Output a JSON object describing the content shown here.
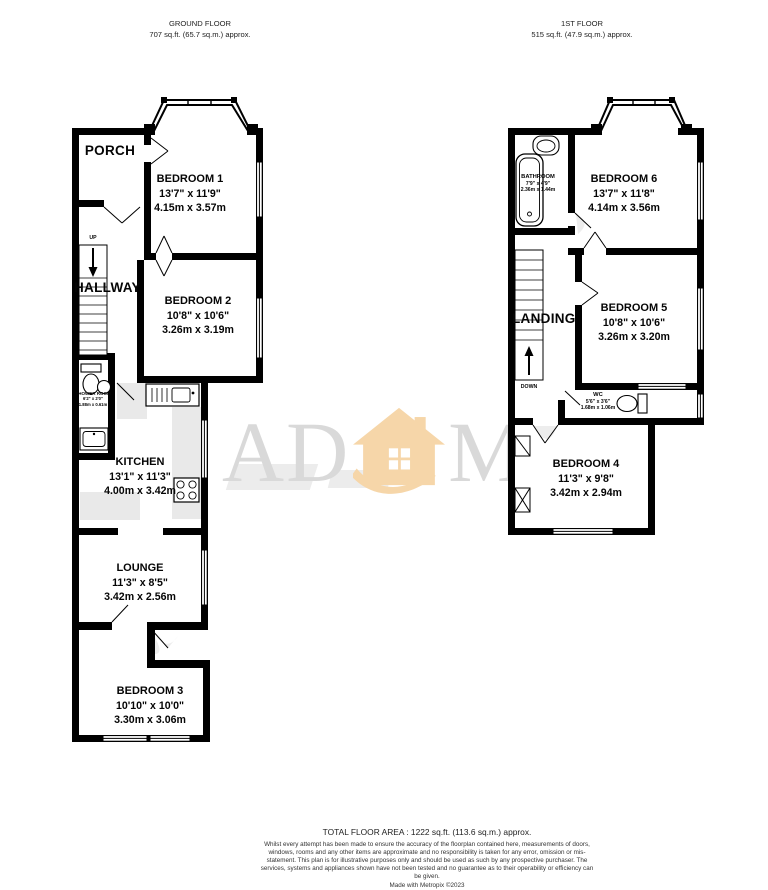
{
  "floors": {
    "ground": {
      "title": "GROUND FLOOR",
      "area": "707 sq.ft. (65.7 sq.m.) approx.",
      "stair_direction": "UP",
      "rooms": {
        "porch": {
          "name": "PORCH"
        },
        "hallway": {
          "name": "HALLWAY"
        },
        "bedroom1": {
          "name": "BEDROOM 1",
          "imperial": "13'7\" x 11'9\"",
          "metric": "4.15m x 3.57m"
        },
        "bedroom2": {
          "name": "BEDROOM 2",
          "imperial": "10'8\" x 10'6\"",
          "metric": "3.26m x 3.19m"
        },
        "shower": {
          "name": "SHOWER ROOM",
          "imperial": "6'2\" x 2'0\"",
          "metric": "1.88m x 0.61m"
        },
        "kitchen": {
          "name": "KITCHEN",
          "imperial": "13'1\" x 11'3\"",
          "metric": "4.00m x 3.42m"
        },
        "lounge": {
          "name": "LOUNGE",
          "imperial": "11'3\" x 8'5\"",
          "metric": "3.42m x 2.56m"
        },
        "bedroom3": {
          "name": "BEDROOM 3",
          "imperial": "10'10\" x 10'0\"",
          "metric": "3.30m x 3.06m"
        }
      }
    },
    "first": {
      "title": "1ST FLOOR",
      "area": "515 sq.ft. (47.9 sq.m.) approx.",
      "stair_direction": "DOWN",
      "rooms": {
        "bathroom": {
          "name": "BATHROOM",
          "imperial": "7'9\" x 4'9\"",
          "metric": "2.36m x 1.44m"
        },
        "landing": {
          "name": "LANDING"
        },
        "bedroom6": {
          "name": "BEDROOM 6",
          "imperial": "13'7\" x 11'8\"",
          "metric": "4.14m x 3.56m"
        },
        "bedroom5": {
          "name": "BEDROOM 5",
          "imperial": "10'8\" x 10'6\"",
          "metric": "3.26m x 3.20m"
        },
        "wc": {
          "name": "WC",
          "imperial": "5'6\" x 3'6\"",
          "metric": "1.68m x 1.06m"
        },
        "bedroom4": {
          "name": "BEDROOM 4",
          "imperial": "11'3\" x 9'8\"",
          "metric": "3.42m x 2.94m"
        }
      }
    }
  },
  "watermark": {
    "prefix": "AD",
    "suffix": "MS"
  },
  "footer": {
    "total_area": "TOTAL FLOOR AREA : 1222 sq.ft. (113.6 sq.m.) approx.",
    "disclaimer": "Whilst every attempt has been made to ensure the accuracy of the floorplan contained here, measurements of doors, windows, rooms and any other items are approximate and no responsibility is taken for any error, omission or mis-statement. This plan is for illustrative purposes only and should be used as such by any prospective purchaser. The services, systems and appliances shown have not been tested and no guarantee as to their operability or efficiency can be given.",
    "credit": "Made with Metropix ©2023"
  },
  "colors": {
    "wall": "#000000",
    "counter": "#e9e9e9",
    "watermark_gray": "#d9d9d9",
    "watermark_orange": "#f6d6a9"
  }
}
